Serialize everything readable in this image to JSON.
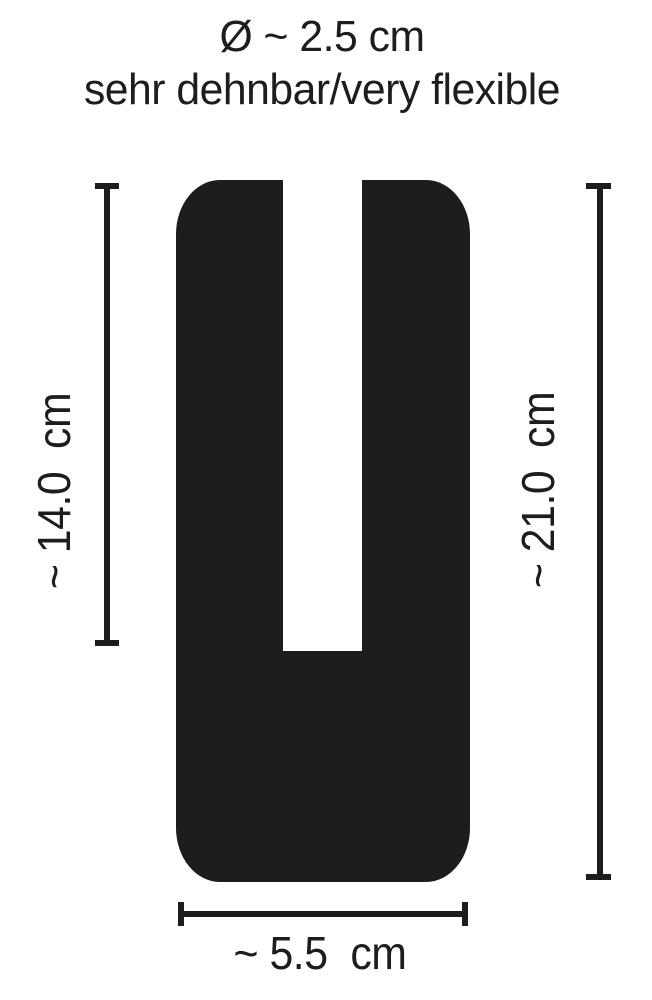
{
  "title": {
    "diameter_line": "Ø ~ 2.5 cm",
    "flexibility_line": "sehr dehnbar/very flexible"
  },
  "dimension_labels": {
    "left_slot_depth": "~ 14.0  cm",
    "right_total_length": "~ 21.0  cm",
    "bottom_width": "~ 5.5  cm"
  },
  "dimensions": {
    "diameter_cm": 2.5,
    "slot_depth_cm": 14.0,
    "total_length_cm": 21.0,
    "width_cm": 5.5,
    "unit": "cm"
  },
  "colors": {
    "ink": "#1d1d1b",
    "background": "#ffffff"
  }
}
